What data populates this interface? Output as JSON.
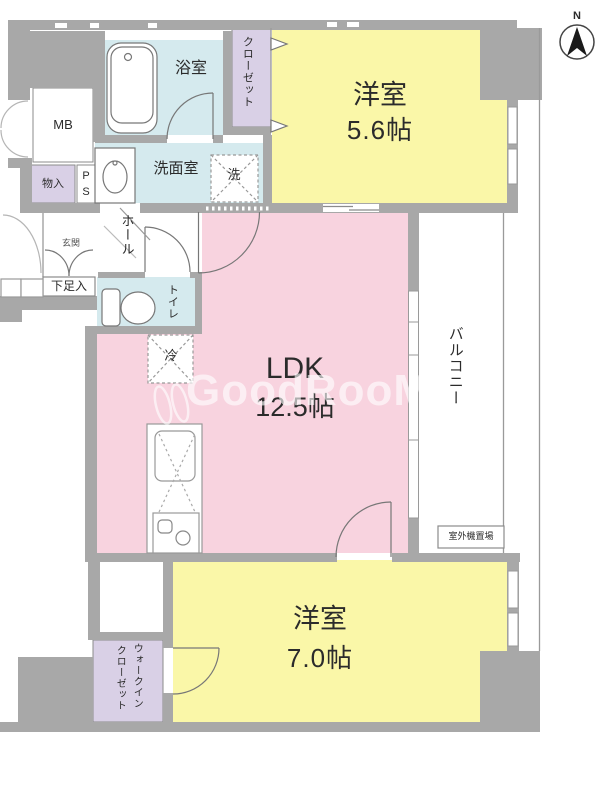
{
  "compass": {
    "north_label": "N"
  },
  "watermark": {
    "text": "GoodRooM"
  },
  "rooms": {
    "bedroom1": {
      "name": "洋室",
      "area": "5.6帖"
    },
    "bedroom2": {
      "name": "洋室",
      "area": "7.0帖"
    },
    "ldk": {
      "name": "LDK",
      "area": "12.5帖"
    },
    "bathroom": {
      "name": "浴室"
    },
    "washroom": {
      "name": "洗面室"
    },
    "toilet": {
      "name": "トイレ"
    },
    "hall": {
      "name": "ホール"
    },
    "entrance": {
      "name": "玄関"
    },
    "balcony": {
      "name": "バルコニー"
    },
    "closet": {
      "name": "クローゼット"
    },
    "walk_in_closet": {
      "line1": "ウォークイン",
      "line2": "クローゼット"
    },
    "shoe_cabinet": {
      "name": "下足入"
    },
    "storage": {
      "name": "物入"
    },
    "meter_box": {
      "name": "MB"
    },
    "pipe_space": {
      "name": "P\nS"
    },
    "refrigerator": {
      "name": "冷"
    },
    "washer": {
      "name": "洗"
    },
    "outdoor_unit": {
      "name": "室外機置場"
    }
  },
  "colors": {
    "room_pink": "#f8d3df",
    "room_yellow": "#faf7a8",
    "wet_blue": "#d5eaee",
    "closet_lavender": "#d9d0e6",
    "wall_gray": "#a8a8a8",
    "line_gray": "#8b8b8b"
  }
}
